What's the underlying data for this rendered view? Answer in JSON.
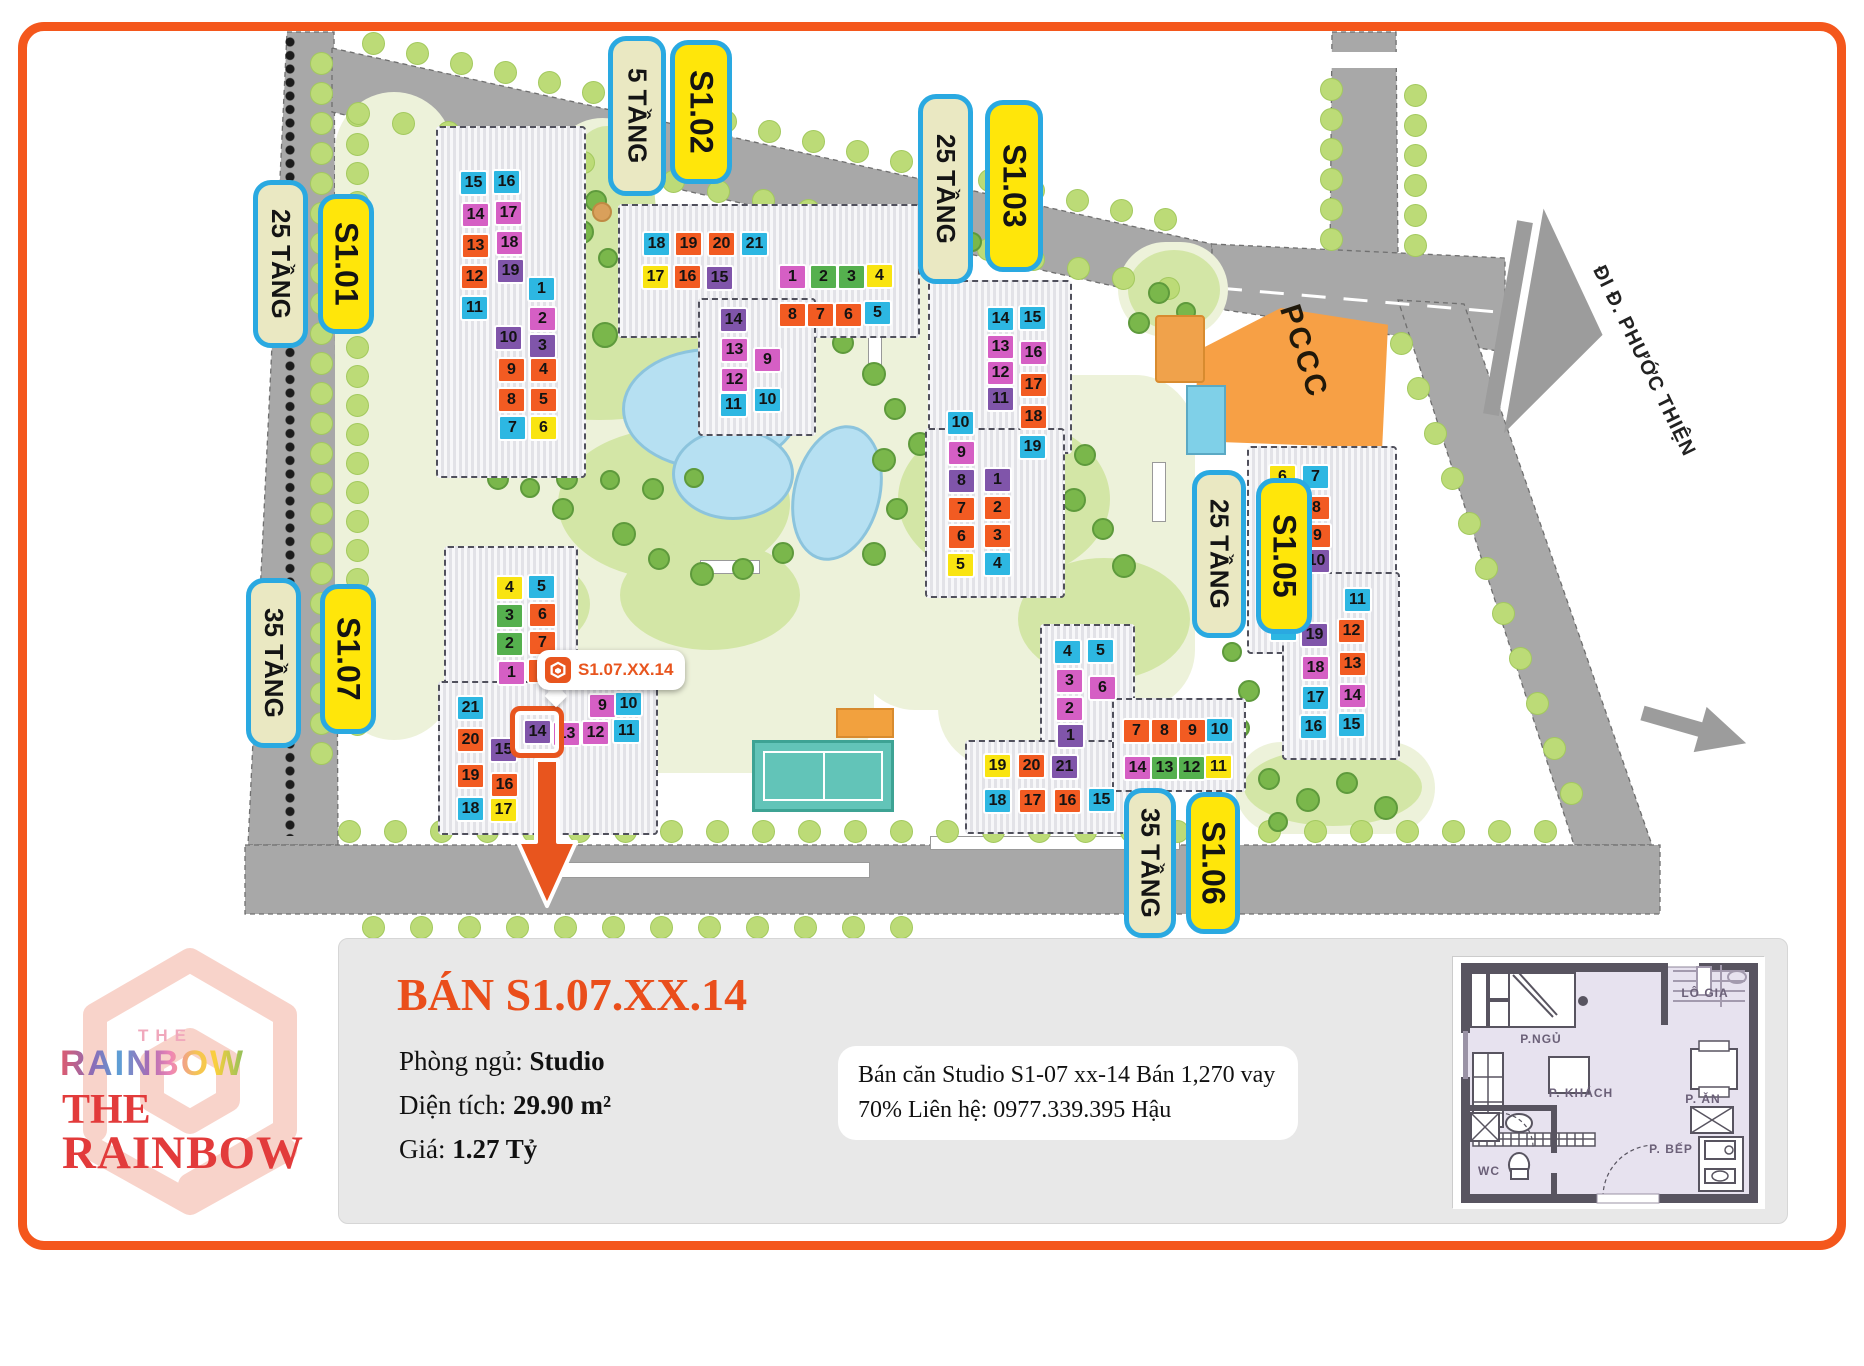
{
  "page": {
    "border_color": "#f4571c"
  },
  "map": {
    "road_sign": "ĐI Đ. PHƯỚC THIỆN",
    "pccc": "PCCC",
    "s_mark": "S",
    "palette": {
      "b": "#2db7e2",
      "o": "#f25b22",
      "p": "#d55fc4",
      "u": "#8055aa",
      "y": "#f9e411",
      "g": "#55b04e"
    },
    "labels": [
      {
        "text": "25 TẦNG",
        "style": "beige",
        "x": 253,
        "y": 180,
        "w": 55,
        "h": 168
      },
      {
        "text": "S1.01",
        "style": "yellow",
        "x": 318,
        "y": 194,
        "w": 56,
        "h": 140
      },
      {
        "text": "35 TẦNG",
        "style": "beige",
        "x": 246,
        "y": 578,
        "w": 55,
        "h": 170
      },
      {
        "text": "S1.07",
        "style": "yellow",
        "x": 320,
        "y": 584,
        "w": 56,
        "h": 150
      },
      {
        "text": "5 TẦNG",
        "style": "beige",
        "x": 608,
        "y": 36,
        "w": 58,
        "h": 160
      },
      {
        "text": "S1.02",
        "style": "yellow",
        "x": 670,
        "y": 40,
        "w": 62,
        "h": 144
      },
      {
        "text": "25 TẦNG",
        "style": "beige",
        "x": 918,
        "y": 94,
        "w": 55,
        "h": 190
      },
      {
        "text": "S1.03",
        "style": "yellow",
        "x": 985,
        "y": 100,
        "w": 58,
        "h": 172
      },
      {
        "text": "25 TẦNG",
        "style": "beige",
        "x": 1192,
        "y": 470,
        "w": 54,
        "h": 168
      },
      {
        "text": "S1.05",
        "style": "yellow",
        "x": 1256,
        "y": 478,
        "w": 56,
        "h": 156
      },
      {
        "text": "35 TẦNG",
        "style": "beige",
        "x": 1124,
        "y": 788,
        "w": 52,
        "h": 150
      },
      {
        "text": "S1.06",
        "style": "yellow",
        "x": 1186,
        "y": 792,
        "w": 54,
        "h": 142
      }
    ],
    "buildings": [
      {
        "id": "S1.01",
        "cells": [
          [
            15,
            "b",
            459,
            170
          ],
          [
            16,
            "b",
            492,
            169
          ],
          [
            14,
            "p",
            461,
            202
          ],
          [
            17,
            "p",
            494,
            200
          ],
          [
            13,
            "o",
            461,
            233
          ],
          [
            18,
            "p",
            495,
            230
          ],
          [
            12,
            "o",
            460,
            264
          ],
          [
            19,
            "u",
            496,
            258
          ],
          [
            11,
            "b",
            460,
            295
          ],
          [
            1,
            "b",
            527,
            276
          ],
          [
            2,
            "p",
            528,
            306
          ],
          [
            10,
            "u",
            494,
            325
          ],
          [
            3,
            "u",
            528,
            333
          ],
          [
            9,
            "o",
            497,
            357
          ],
          [
            4,
            "o",
            529,
            357
          ],
          [
            8,
            "o",
            497,
            387
          ],
          [
            5,
            "o",
            529,
            387
          ],
          [
            7,
            "b",
            498,
            415
          ],
          [
            6,
            "y",
            529,
            415
          ]
        ]
      },
      {
        "id": "S1.02",
        "cells": [
          [
            18,
            "b",
            642,
            231
          ],
          [
            19,
            "o",
            674,
            231
          ],
          [
            20,
            "o",
            707,
            231
          ],
          [
            21,
            "b",
            740,
            231
          ],
          [
            17,
            "y",
            641,
            264
          ],
          [
            16,
            "o",
            673,
            264
          ],
          [
            15,
            "u",
            705,
            265
          ],
          [
            1,
            "p",
            778,
            264
          ],
          [
            2,
            "g",
            809,
            264
          ],
          [
            3,
            "g",
            837,
            264
          ],
          [
            4,
            "y",
            865,
            263
          ],
          [
            8,
            "o",
            778,
            302
          ],
          [
            7,
            "o",
            806,
            302
          ],
          [
            6,
            "o",
            834,
            302
          ],
          [
            5,
            "b",
            863,
            300
          ],
          [
            14,
            "u",
            719,
            307
          ],
          [
            13,
            "p",
            720,
            337
          ],
          [
            9,
            "p",
            753,
            347
          ],
          [
            12,
            "p",
            720,
            367
          ],
          [
            11,
            "b",
            719,
            392
          ],
          [
            10,
            "b",
            753,
            387
          ]
        ]
      },
      {
        "id": "S1.03",
        "cells": [
          [
            14,
            "b",
            986,
            306
          ],
          [
            15,
            "b",
            1018,
            305
          ],
          [
            13,
            "p",
            986,
            334
          ],
          [
            16,
            "p",
            1019,
            340
          ],
          [
            12,
            "p",
            986,
            360
          ],
          [
            11,
            "u",
            986,
            386
          ],
          [
            17,
            "o",
            1019,
            372
          ],
          [
            10,
            "b",
            946,
            410
          ],
          [
            18,
            "o",
            1019,
            404
          ],
          [
            9,
            "p",
            947,
            440
          ],
          [
            19,
            "b",
            1018,
            434
          ],
          [
            8,
            "u",
            947,
            468
          ],
          [
            1,
            "u",
            983,
            467
          ],
          [
            7,
            "o",
            947,
            496
          ],
          [
            2,
            "o",
            983,
            495
          ],
          [
            6,
            "o",
            947,
            524
          ],
          [
            3,
            "o",
            983,
            523
          ],
          [
            5,
            "y",
            946,
            552
          ],
          [
            4,
            "b",
            983,
            551
          ]
        ]
      },
      {
        "id": "S1.05",
        "cells": [
          [
            6,
            "y",
            1268,
            464
          ],
          [
            7,
            "b",
            1301,
            464
          ],
          [
            5,
            "o",
            1268,
            495
          ],
          [
            8,
            "o",
            1302,
            495
          ],
          [
            4,
            "o",
            1268,
            524
          ],
          [
            9,
            "o",
            1303,
            523
          ],
          [
            3,
            "u",
            1269,
            552
          ],
          [
            10,
            "u",
            1302,
            548
          ],
          [
            2,
            "p",
            1268,
            584
          ],
          [
            11,
            "b",
            1343,
            587
          ],
          [
            1,
            "b",
            1269,
            616
          ],
          [
            19,
            "u",
            1300,
            622
          ],
          [
            12,
            "o",
            1337,
            618
          ],
          [
            18,
            "p",
            1301,
            655
          ],
          [
            13,
            "o",
            1338,
            651
          ],
          [
            17,
            "b",
            1301,
            685
          ],
          [
            14,
            "p",
            1338,
            683
          ],
          [
            16,
            "b",
            1299,
            714
          ],
          [
            15,
            "b",
            1337,
            712
          ]
        ]
      },
      {
        "id": "S1.06",
        "cells": [
          [
            4,
            "b",
            1053,
            639
          ],
          [
            5,
            "b",
            1086,
            638
          ],
          [
            3,
            "p",
            1055,
            668
          ],
          [
            6,
            "p",
            1088,
            675
          ],
          [
            2,
            "p",
            1055,
            696
          ],
          [
            1,
            "u",
            1056,
            723
          ],
          [
            19,
            "y",
            983,
            753
          ],
          [
            20,
            "o",
            1017,
            753
          ],
          [
            21,
            "u",
            1050,
            754
          ],
          [
            18,
            "b",
            983,
            788
          ],
          [
            17,
            "o",
            1018,
            788
          ],
          [
            16,
            "o",
            1053,
            788
          ],
          [
            15,
            "b",
            1087,
            787
          ],
          [
            7,
            "o",
            1122,
            718
          ],
          [
            8,
            "o",
            1150,
            718
          ],
          [
            9,
            "o",
            1178,
            718
          ],
          [
            10,
            "b",
            1205,
            717
          ],
          [
            14,
            "p",
            1123,
            755
          ],
          [
            13,
            "g",
            1150,
            755
          ],
          [
            12,
            "g",
            1177,
            755
          ],
          [
            11,
            "y",
            1204,
            754
          ]
        ]
      },
      {
        "id": "S1.07",
        "cells": [
          [
            4,
            "y",
            495,
            575
          ],
          [
            5,
            "b",
            527,
            574
          ],
          [
            3,
            "g",
            495,
            603
          ],
          [
            6,
            "o",
            528,
            602
          ],
          [
            2,
            "g",
            495,
            631
          ],
          [
            7,
            "o",
            528,
            630
          ],
          [
            1,
            "p",
            497,
            660
          ],
          [
            8,
            "o",
            527,
            658
          ],
          [
            21,
            "b",
            456,
            695
          ],
          [
            20,
            "o",
            456,
            727
          ],
          [
            15,
            "u",
            489,
            737
          ],
          [
            19,
            "o",
            456,
            763
          ],
          [
            16,
            "o",
            490,
            772
          ],
          [
            18,
            "b",
            456,
            796
          ],
          [
            17,
            "y",
            489,
            797
          ],
          [
            9,
            "p",
            588,
            693
          ],
          [
            10,
            "b",
            614,
            691
          ],
          [
            14,
            "u",
            523,
            719
          ],
          [
            13,
            "p",
            552,
            721
          ],
          [
            12,
            "p",
            581,
            720
          ],
          [
            11,
            "b",
            612,
            718
          ]
        ]
      }
    ],
    "marker": {
      "label": "S1.07.XX.14",
      "building": "S1.07",
      "unit": 14
    }
  },
  "panel": {
    "title": "BÁN S1.07.XX.14",
    "specs": [
      {
        "label": "Phòng ngủ: ",
        "value": "Studio"
      },
      {
        "label": "Diện tích: ",
        "value": "29.90 m²"
      },
      {
        "label": "Giá: ",
        "value": "1.27 Tỷ"
      }
    ],
    "description": "Bán căn Studio S1-07 xx-14 Bán 1,270 vay 70% Liên hệ: 0977.339.395 Hậu"
  },
  "logo": {
    "the_small": "THE",
    "rainbow_gradient": "RAINBOW",
    "the_serif": "THE",
    "rainbow_serif": "RAINBOW"
  },
  "floorplan": {
    "rooms": [
      "P.NGỦ",
      "LÔ GIA",
      "P. KHÁCH",
      "P. ĂN",
      "P. BẾP",
      "WC"
    ]
  }
}
